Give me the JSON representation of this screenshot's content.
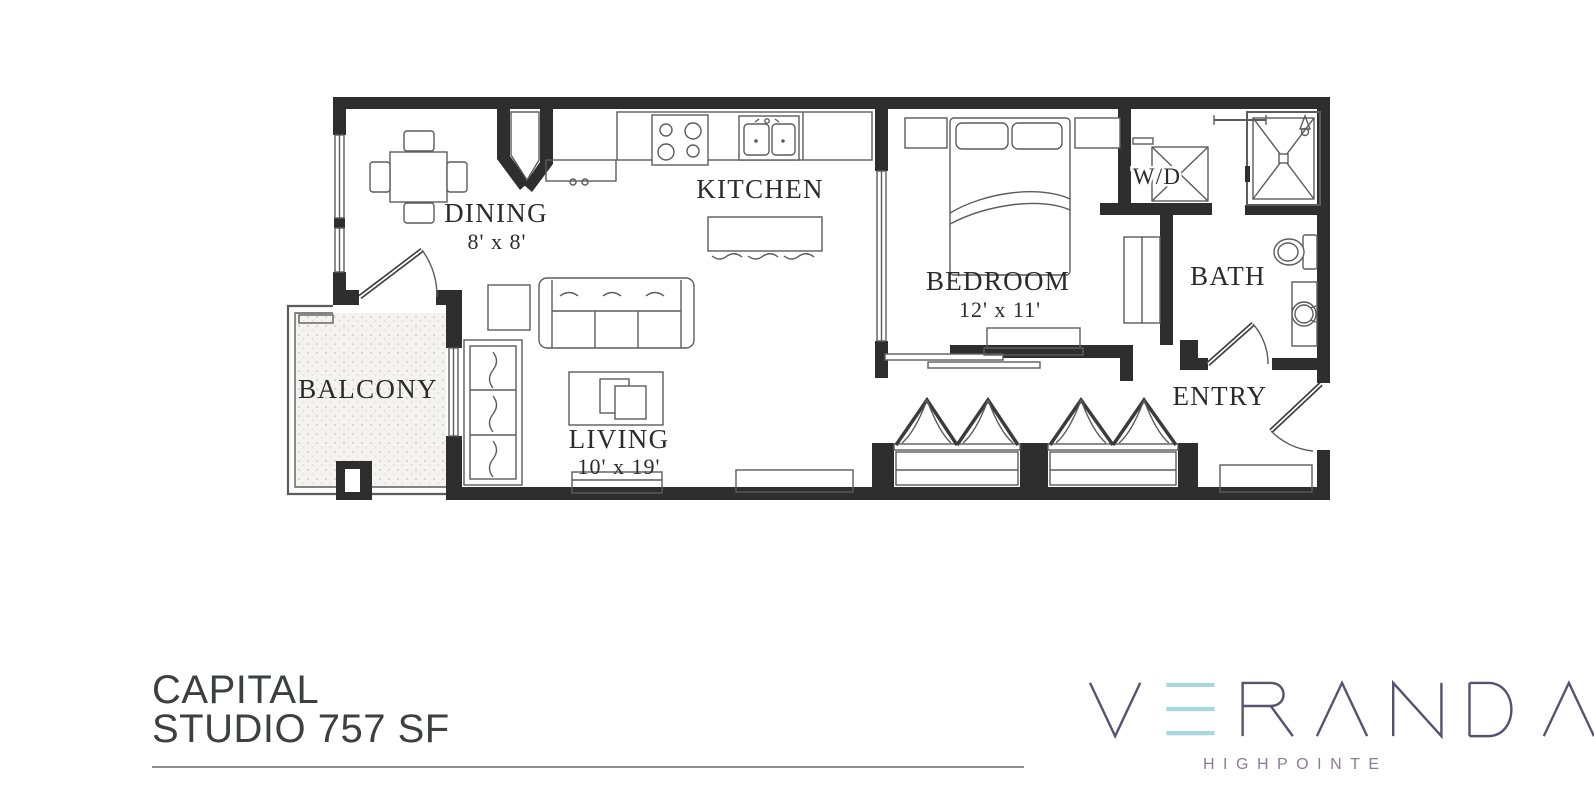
{
  "floorplan": {
    "rooms": [
      {
        "id": "dining",
        "name": "DINING",
        "dims": "8' x 8'"
      },
      {
        "id": "kitchen",
        "name": "KITCHEN",
        "dims": ""
      },
      {
        "id": "living",
        "name": "LIVING",
        "dims": "10' x 19'"
      },
      {
        "id": "bedroom",
        "name": "BEDROOM",
        "dims": "12' x 11'"
      },
      {
        "id": "washer-dryer",
        "name": "W/D",
        "dims": ""
      },
      {
        "id": "bath",
        "name": "BATH",
        "dims": ""
      },
      {
        "id": "entry",
        "name": "ENTRY",
        "dims": ""
      },
      {
        "id": "balcony",
        "name": "BALCONY",
        "dims": ""
      }
    ]
  },
  "footer": {
    "line1": "CAPITAL",
    "line2": "STUDIO 757 SF"
  },
  "brand": {
    "name": "VERANDA",
    "subtitle": "HIGHPOINTE"
  },
  "colors": {
    "wall": "#2e2e2e",
    "line": "#5c5c5c",
    "label": "#2b2b2b",
    "footer-text": "#3e3f40",
    "rule": "#8f8f8f",
    "logo-purple": "#585270",
    "logo-accent": "#a7d8dd",
    "logo-subtitle": "#8b7b9b"
  }
}
